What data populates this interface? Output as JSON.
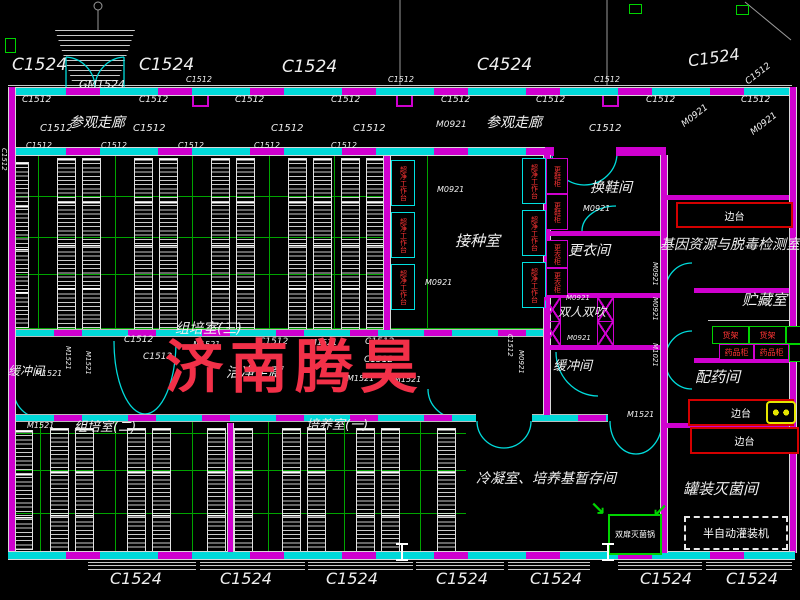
{
  "watermark": {
    "text": "济南腾昊",
    "color": "#f23048"
  },
  "rooms": {
    "visit_corridor": "参观走廊",
    "clean_corridor": "洁净走廊",
    "culture3": "组培室(三)",
    "culture2": "组培室(二)",
    "grow1": "培养室(一)",
    "inoculation": "接种室",
    "shoe_room": "换鞋间",
    "dress_room": "更衣间",
    "air_shower": "双人双吹",
    "buffer": "缓冲间",
    "gene_lab": "基因资源与脱毒检测室",
    "storage": "贮藏室",
    "dispensary": "配药间",
    "canning": "罐装灭菌间",
    "cooling": "冷凝室、培养基暂存间"
  },
  "equipment": {
    "side_bench": "边台",
    "shelf_rack": "货架",
    "medicine_cabinet": "药品柜",
    "clean_bench": "超净工作台",
    "shoe_cabinet": "更鞋柜",
    "wardrobe": "更衣柜",
    "sterilizer": "双扉灭菌锅",
    "filler": "半自动灌装机"
  },
  "codes": {
    "c1524": "C1524",
    "c4524": "C4524",
    "c1512": "C1512",
    "gm1524": "GM1524",
    "m0921": "M0921",
    "m1521": "M1521",
    "m1021": "M1021"
  },
  "colors": {
    "wall": "#cf00cf",
    "window": "#00d9d9",
    "grid_green": "#00a400",
    "equipment_green": "#00d400",
    "equipment_red": "#d40000",
    "red_text": "#ff3434",
    "text": "#efefef",
    "sink_yellow": "#e6e600",
    "watermark_red": "#f23048"
  }
}
